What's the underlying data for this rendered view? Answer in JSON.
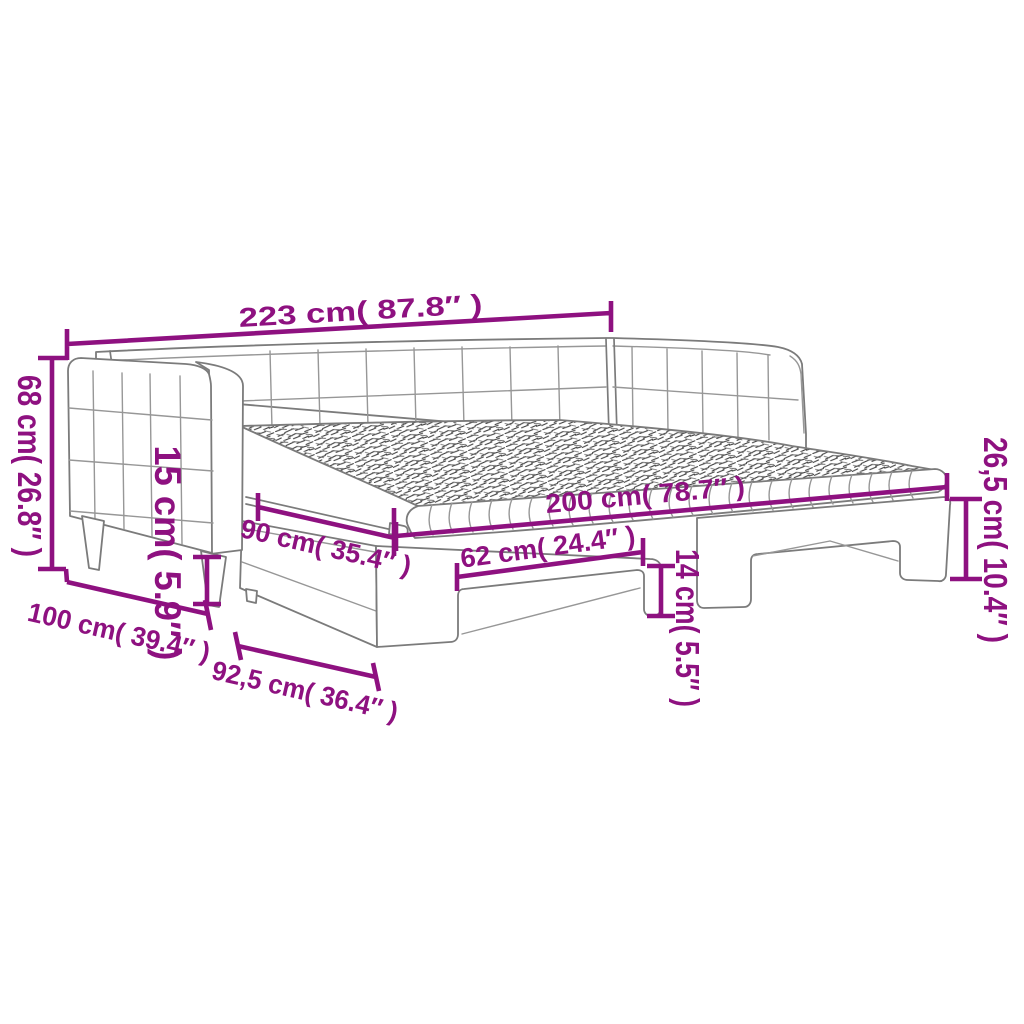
{
  "diagram": {
    "kind": "product-dimension-diagram",
    "subject": "daybed with pull-out trundle bed",
    "background": "#ffffff",
    "colors": {
      "dimension": "#8E1180",
      "outline": "#7b7b7b",
      "mattress_hatch": "#3a3a3a"
    },
    "dims": {
      "total_length": "223 cm( 87.8″ )",
      "back_height": "68 cm( 26.8″ )",
      "under_clearance": "15 cm( 5.9″ )",
      "armrest_depth": "100 cm( 39.4″ )",
      "trundle_depth": "92,5 cm( 36.4″ )",
      "bed_width": "90 cm( 35.4″ )",
      "bed_length": "200 cm( 78.7″ )",
      "trundle_cutout": "62 cm( 24.4″ )",
      "trundle_clearance": "14 cm( 5.5″ )",
      "base_height": "26,5 cm( 10.4″ )"
    }
  }
}
